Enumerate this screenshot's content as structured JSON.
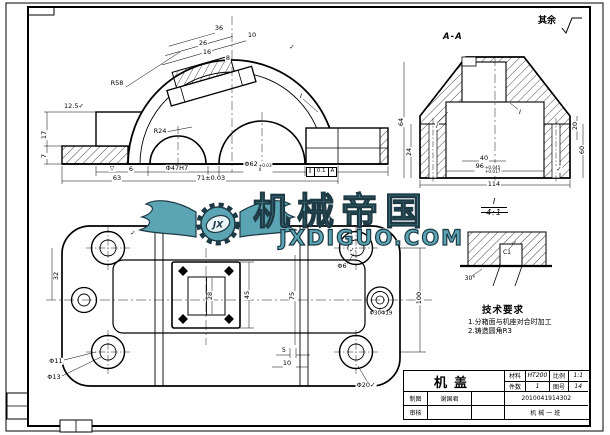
{
  "meta": {
    "line_color": "#000000",
    "sheet_bg": "#ffffff",
    "watermark_teal": "#5ba4b4",
    "watermark_outline": "#1e3a45"
  },
  "corner_note": {
    "text": "其余"
  },
  "section_label": "A-A",
  "detail": {
    "label": "I",
    "scale": "4:1"
  },
  "tech_req": {
    "title": "技术要求",
    "items": [
      "1.分箱面与机座对合时加工",
      "2.铸造圆角R3"
    ]
  },
  "gdt": {
    "symbol": "∥",
    "value": "0.1",
    "datum": "A"
  },
  "watermark": {
    "title": "机械帝国",
    "site": "JXDIGUO.COM",
    "logo_text": "JX"
  },
  "title_block": {
    "part_name": "机盖",
    "material_label": "材料",
    "material_value": "HT200",
    "scale_label": "比例",
    "scale_value": "1:1",
    "qty_label": "件数",
    "qty_value": "1",
    "drawing_no_label": "图号",
    "drawing_no_value": "14",
    "drawn_label": "制图",
    "drawn_value": "谢国君",
    "checked_label": "审核",
    "student_id": "2010041914302",
    "class_name": "机械一班"
  },
  "annotations": [
    {
      "n": "dim-36",
      "t": "36",
      "x": 219,
      "y": 28
    },
    {
      "n": "dim-10",
      "t": "10",
      "x": 252,
      "y": 35
    },
    {
      "n": "dim-26",
      "t": "26",
      "x": 203,
      "y": 43
    },
    {
      "n": "dim-16",
      "t": "16",
      "x": 207,
      "y": 52
    },
    {
      "n": "dim-8",
      "t": "8",
      "x": 228,
      "y": 58
    },
    {
      "n": "roughness-check",
      "t": "✓",
      "x": 292,
      "y": 47
    },
    {
      "n": "radius-R58",
      "t": "R58",
      "x": 117,
      "y": 83
    },
    {
      "n": "radius-R24",
      "t": "R24",
      "x": 160,
      "y": 131
    },
    {
      "n": "roughness-12-5",
      "t": "12.5✓",
      "x": 74,
      "y": 106
    },
    {
      "n": "dim-17",
      "t": "17",
      "x": 44,
      "y": 135,
      "rot": -90
    },
    {
      "n": "dim-7",
      "t": "7",
      "x": 44,
      "y": 156,
      "rot": -90
    },
    {
      "n": "dim-6",
      "t": "6",
      "x": 131,
      "y": 169
    },
    {
      "n": "dim-47H7",
      "t": "Φ47H7",
      "x": 177,
      "y": 168
    },
    {
      "n": "dim-62",
      "t": "Φ62",
      "sup": "+0.03",
      "sub": "0",
      "x": 258,
      "y": 167
    },
    {
      "n": "dim-63",
      "t": "63",
      "x": 117,
      "y": 178
    },
    {
      "n": "dim-71",
      "t": "71±0.03",
      "x": 211,
      "y": 178
    },
    {
      "n": "detail-ref-I",
      "t": "I",
      "x": 301,
      "y": 96,
      "i": 1
    },
    {
      "n": "surface-triangle",
      "t": "▽",
      "x": 112,
      "y": 169,
      "size": 6
    },
    {
      "n": "dim-40",
      "t": "40",
      "x": 484,
      "y": 158
    },
    {
      "n": "dim-96",
      "t": "96",
      "sup": "+0.045",
      "sub": "+0.017",
      "x": 488,
      "y": 169
    },
    {
      "n": "dim-114",
      "t": "114",
      "x": 494,
      "y": 184
    },
    {
      "n": "dim-64",
      "t": "64",
      "x": 401,
      "y": 122,
      "rot": -90
    },
    {
      "n": "dim-24",
      "t": "24",
      "x": 409,
      "y": 152,
      "rot": -90
    },
    {
      "n": "dim-20",
      "t": "20",
      "x": 575,
      "y": 126,
      "rot": -90
    },
    {
      "n": "dim-60",
      "t": "60",
      "x": 582,
      "y": 150,
      "rot": -90
    },
    {
      "n": "detail-ref-I",
      "t": "I",
      "x": 437,
      "y": 126,
      "i": 1
    },
    {
      "n": "detail-ref-I",
      "t": "I",
      "x": 520,
      "y": 112,
      "i": 1
    },
    {
      "n": "roughness-check",
      "t": "✓",
      "x": 559,
      "y": 169
    },
    {
      "n": "dim-C1",
      "t": "C1",
      "x": 507,
      "y": 253,
      "size": 6
    },
    {
      "n": "dim-30deg",
      "t": "30°",
      "x": 470,
      "y": 279,
      "size": 6
    },
    {
      "n": "dim-32",
      "t": "32",
      "x": 56,
      "y": 276,
      "rot": -90
    },
    {
      "n": "dim-45",
      "t": "45",
      "x": 247,
      "y": 295,
      "rot": -90
    },
    {
      "n": "dim-28",
      "t": "28",
      "x": 210,
      "y": 296,
      "rot": -90
    },
    {
      "n": "dim-75",
      "t": "75",
      "x": 292,
      "y": 296,
      "rot": -90
    },
    {
      "n": "dim-100",
      "t": "100",
      "x": 419,
      "y": 298,
      "rot": -90
    },
    {
      "n": "dim-d6",
      "t": "Φ6",
      "x": 342,
      "y": 266
    },
    {
      "n": "dim-d30-d19",
      "t": "Φ30Φ19",
      "x": 381,
      "y": 314,
      "size": 5.5
    },
    {
      "n": "dim-d11",
      "t": "Φ11",
      "x": 56,
      "y": 361
    },
    {
      "n": "dim-d13",
      "t": "Φ13",
      "x": 54,
      "y": 377
    },
    {
      "n": "dim-5",
      "t": "5",
      "x": 284,
      "y": 350
    },
    {
      "n": "dim-10b",
      "t": "10",
      "x": 287,
      "y": 363
    },
    {
      "n": "dim-d20",
      "t": "Φ20✓",
      "x": 366,
      "y": 385
    },
    {
      "n": "roughness-check",
      "t": "✓",
      "x": 133,
      "y": 233
    },
    {
      "n": "roughness-check",
      "t": "✓",
      "x": 352,
      "y": 250
    }
  ]
}
